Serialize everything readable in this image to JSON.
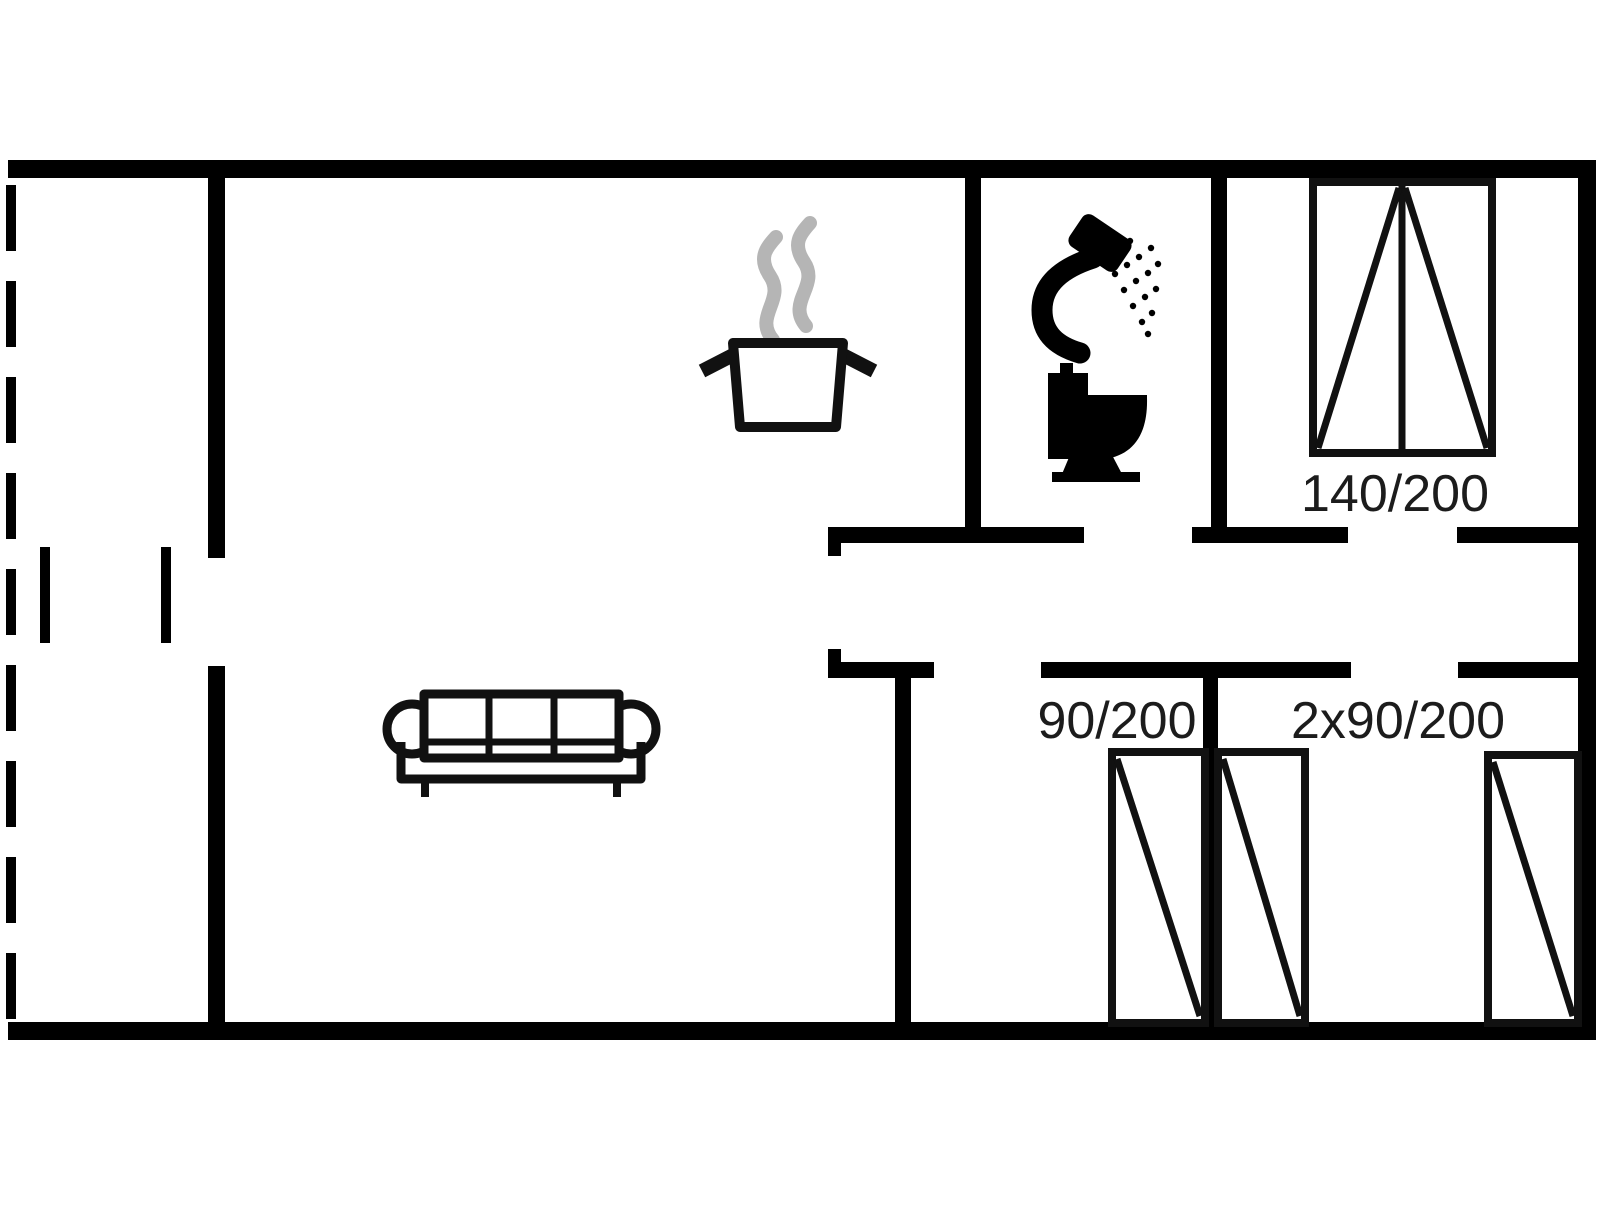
{
  "floorplan": {
    "type": "holiday-house floor plan, single storey",
    "colors": {
      "background": "#ffffff",
      "walls": "#000000",
      "furniture_outline": "#111111",
      "steam": "#b5b5b5",
      "text": "#1c1c1c"
    },
    "labels": {
      "bed_double": "140/200",
      "bed_single": "90/200",
      "bed_twin": "2x90/200"
    },
    "icons": [
      "sofa-icon",
      "cooking-pot-icon",
      "steam-icon",
      "shower-icon",
      "toilet-icon",
      "double-bed-symbol",
      "single-bed-symbol"
    ],
    "rooms": [
      "terrace (dashed open side, left)",
      "living room with sofa",
      "kitchen area with cooking pot",
      "bathroom with shower and toilet",
      "bedroom with double bed 140/200",
      "bedroom with single bed 90/200",
      "bedroom with two single beds 2x90/200"
    ]
  }
}
